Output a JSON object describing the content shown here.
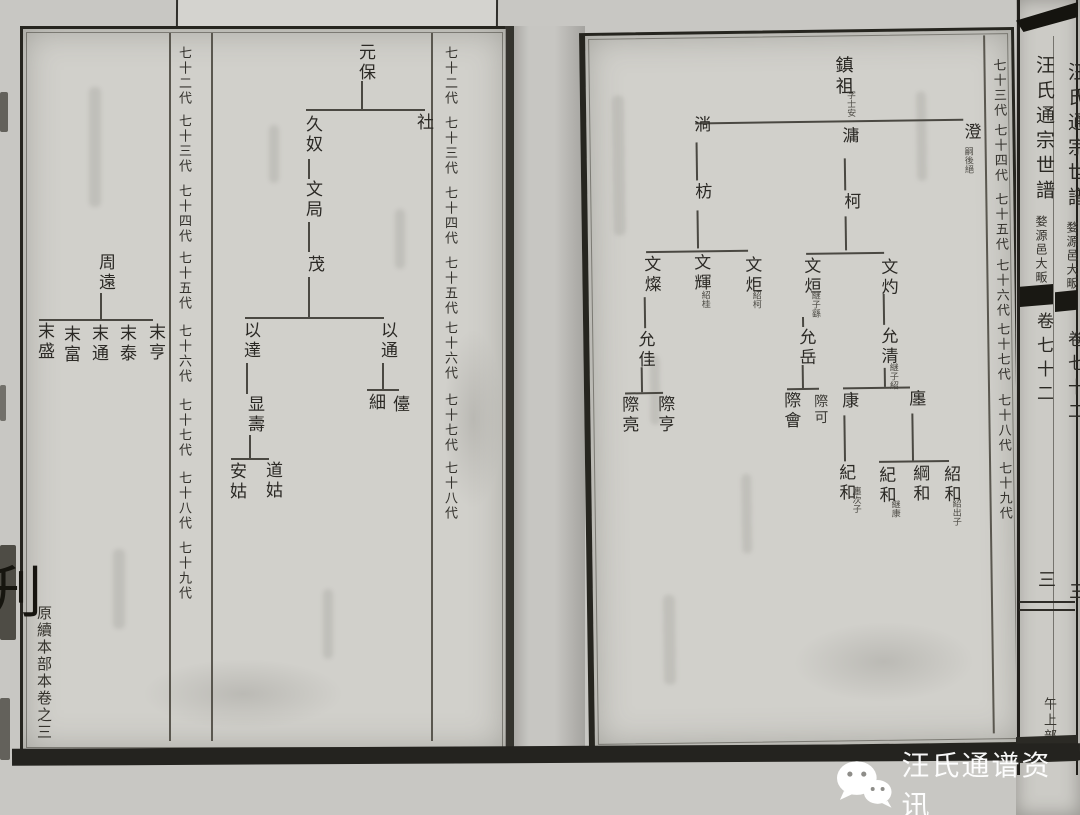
{
  "left_page": {
    "generation_labels_left": [
      "七十二代",
      "七十三代",
      "七十四代",
      "七十五代",
      "七十六代",
      "七十七代",
      "七十八代",
      "七十九代"
    ],
    "generation_labels_right": [
      "七十二代",
      "七十三代",
      "七十四代",
      "七十五代",
      "七十六代",
      "七十七代",
      "七十八代"
    ],
    "margin_note": "原續本部本卷之三",
    "edge_glyph": "刋",
    "nodes": {
      "yuanbao": "元保",
      "she": "社",
      "jiunu": "久奴",
      "wenju": "文局",
      "mao": "茂",
      "yida": "以達",
      "yitong": "以通",
      "xianshou": "显壽",
      "xi": "細",
      "tai": "儓",
      "daogu": "道姑",
      "angu": "安姑",
      "zhouyuan": "周遠",
      "moheng": "末亨",
      "motai": "末泰",
      "motong": "末通",
      "mofu": "末富",
      "mosheng": "末盛"
    }
  },
  "right_page": {
    "generation_labels": [
      "七十三代",
      "七十四代",
      "七十五代",
      "七十六代",
      "七十七代",
      "七十八代",
      "七十九代"
    ],
    "nodes": {
      "zhenzu": "鎮祖",
      "zhenzu_note": "字士安",
      "cheng": "澄",
      "cheng_note": "嗣後絕",
      "yong": "滽",
      "ke": "柯",
      "tang": "淌",
      "fang": "枋",
      "wencan": "文燦",
      "wenhui": "文輝",
      "wenhui_note": "紹桂",
      "wenju": "文炬",
      "wenju_note": "紹柯",
      "wenxuan": "文烜",
      "wenxuan_note": "継子繇",
      "wenzhuo": "文灼",
      "yunjia": "允佳",
      "yunyue": "允岳",
      "yunqing": "允清",
      "yunqing_note": "継子紹",
      "jiliang": "際亮",
      "jiheng": "際亨",
      "jihui": "際會",
      "jike": "際可",
      "kang": "康",
      "chan": "廛",
      "jihe_kang": "紀和",
      "jihe_kang_note": "廛次子",
      "jihe_chan": "紀和",
      "jihe_chan_note": "継康",
      "ganghe": "綱和",
      "shaohe": "紹和",
      "shaohe_note": "紹出子"
    }
  },
  "spine": {
    "title": "汪氏通宗世譜",
    "subtitle": "婺源邑大畈",
    "volume": "卷七十二",
    "page_number": "三",
    "section_label": "午上部"
  },
  "watermark": {
    "text": "汪氏通谱资讯",
    "icon": "wechat-icon"
  }
}
